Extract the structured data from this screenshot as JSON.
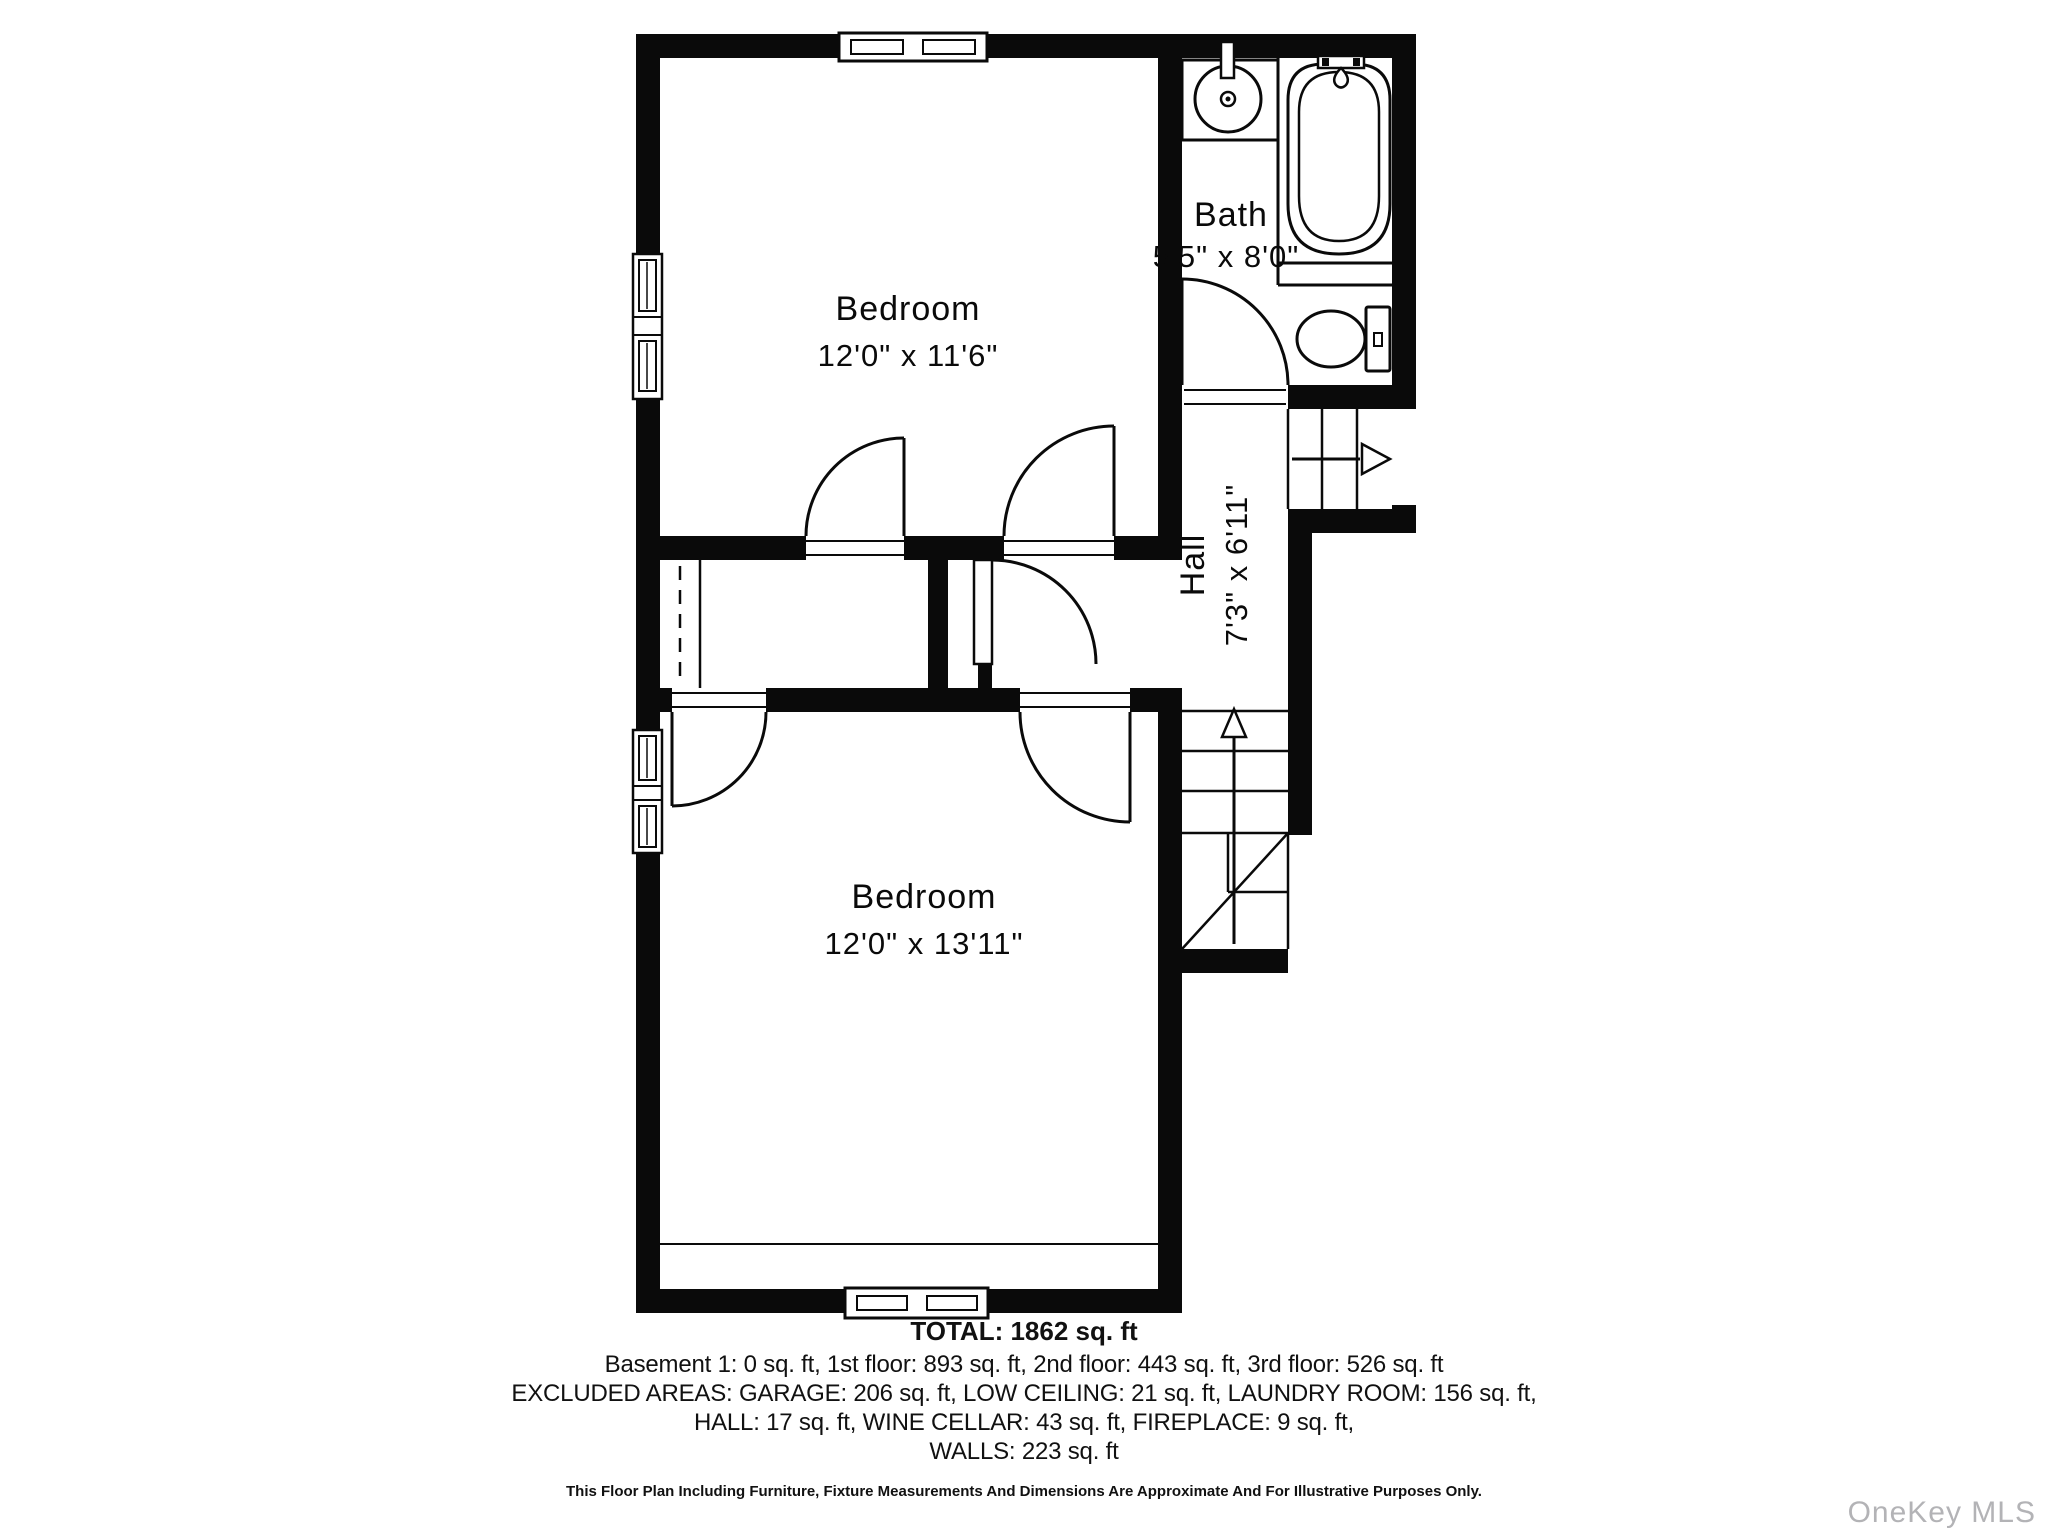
{
  "plan": {
    "rooms": {
      "bedroom_top": {
        "name": "Bedroom",
        "dims": "12'0\" x 11'6\""
      },
      "bath": {
        "name": "Bath",
        "dims": "5'5\" x 8'0\""
      },
      "hall": {
        "name": "Hall",
        "dims": "7'3\" x 6'11\""
      },
      "bedroom_bottom": {
        "name": "Bedroom",
        "dims": "12'0\" x 13'11\""
      }
    }
  },
  "summary": {
    "total": "TOTAL: 1862 sq. ft",
    "floors": "Basement 1: 0 sq. ft, 1st floor: 893 sq. ft, 2nd floor: 443 sq. ft, 3rd floor: 526 sq. ft",
    "excluded_line1": "EXCLUDED AREAS: GARAGE: 206 sq. ft, LOW CEILING: 21 sq. ft, LAUNDRY ROOM: 156 sq. ft,",
    "excluded_line2": "HALL: 17 sq. ft, WINE CELLAR: 43 sq. ft, FIREPLACE: 9 sq. ft,",
    "excluded_line3": "WALLS: 223 sq. ft",
    "disclaimer": "This Floor Plan Including Furniture, Fixture Measurements And Dimensions Are Approximate And For Illustrative Purposes Only."
  },
  "watermark": "OneKey MLS",
  "colors": {
    "line": "#0a0a0a",
    "wall": "#0a0a0a",
    "watermark": "#b3b3b6",
    "background": "#ffffff"
  }
}
